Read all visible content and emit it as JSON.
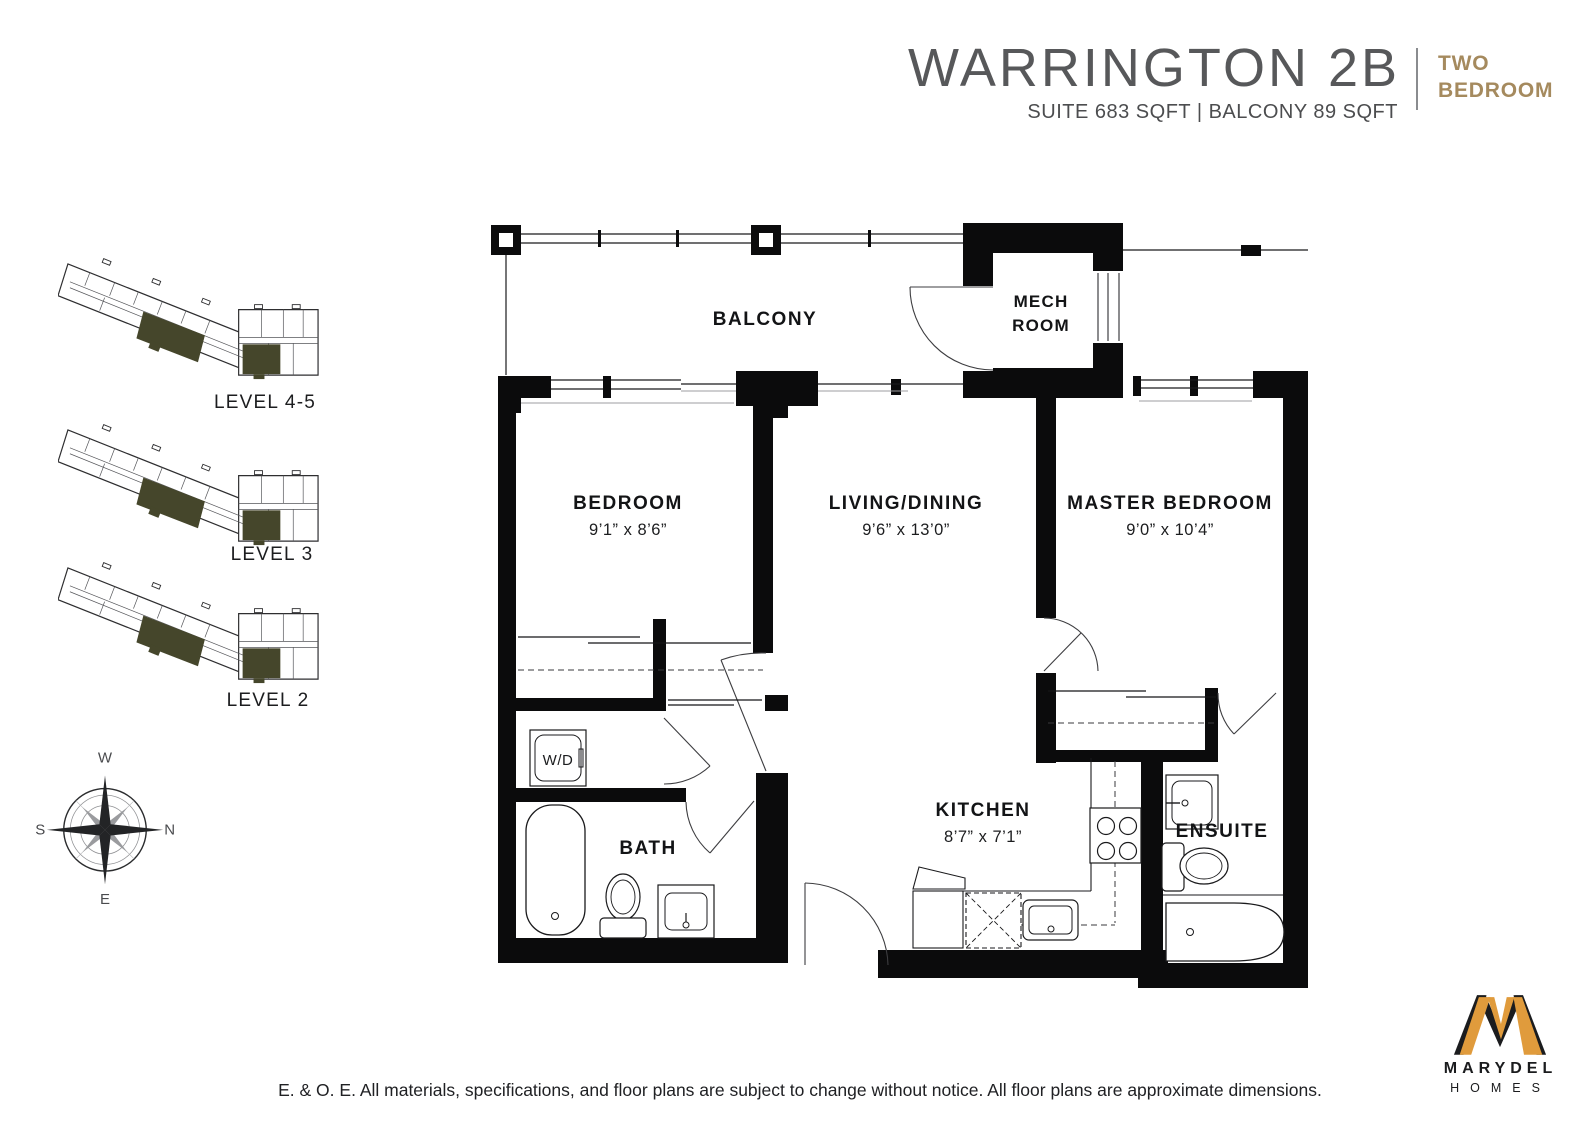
{
  "header": {
    "title": "WARRINGTON 2B",
    "unit_type": {
      "line1": "TWO",
      "line2": "BEDROOM"
    },
    "subtitle": "SUITE 683 SQFT | BALCONY 89 SQFT"
  },
  "key_plans": {
    "levels": [
      {
        "label": "LEVEL 4-5"
      },
      {
        "label": "LEVEL 3"
      },
      {
        "label": "LEVEL 2"
      }
    ]
  },
  "compass": {
    "top": "W",
    "right": "N",
    "left": "S",
    "bottom": "E"
  },
  "floor_plan": {
    "balcony_label": "BALCONY",
    "mech_room_line1": "MECH",
    "mech_room_line2": "ROOM",
    "bedroom_label": "BEDROOM",
    "bedroom_dims": "9’1” x 8’6”",
    "living_dining_label": "LIVING/DINING",
    "living_dining_dims": "9’6” x 13’0”",
    "master_bedroom_label": "MASTER BEDROOM",
    "master_bedroom_dims": "9’0” x 10’4”",
    "bath_label": "BATH",
    "kitchen_label": "KITCHEN",
    "kitchen_dims": "8’7” x 7’1”",
    "ensuite_label": "ENSUITE",
    "washer_dryer_label": "W/D"
  },
  "footer": {
    "disclaimer": "E. & O. E.  All materials, specifications, and floor plans are subject to change without notice. All floor plans are approximate dimensions."
  },
  "logo": {
    "name": "MARYDEL",
    "suffix": "HOMES"
  },
  "colors": {
    "title_gray": "#57585a",
    "accent_tan": "#a58a5e",
    "unit_highlight": "#45462b",
    "logo_gold": "#e09b3c"
  }
}
